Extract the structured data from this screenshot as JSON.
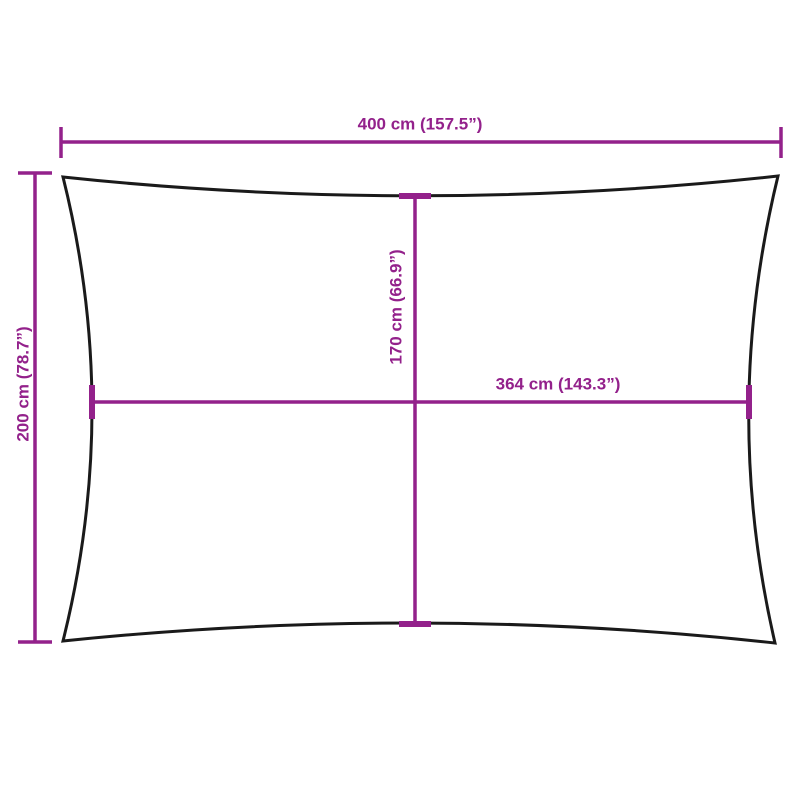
{
  "diagram": {
    "type": "product-dimension-diagram",
    "product_shape": "rectangle-concave-edges",
    "dimensions": {
      "outer_width": {
        "label": "400 cm (157.5”)",
        "value_cm": 400,
        "value_in": 157.5
      },
      "outer_height": {
        "label": "200 cm (78.7”)",
        "value_cm": 200,
        "value_in": 78.7
      },
      "inner_height": {
        "label": "170 cm (66.9”)",
        "value_cm": 170,
        "value_in": 66.9
      },
      "inner_width": {
        "label": "364 cm (143.3”)",
        "value_cm": 364,
        "value_in": 143.3
      }
    },
    "colors": {
      "dimension": "#93218B",
      "outline": "#1A1A1A",
      "background": "#FFFFFF"
    }
  }
}
